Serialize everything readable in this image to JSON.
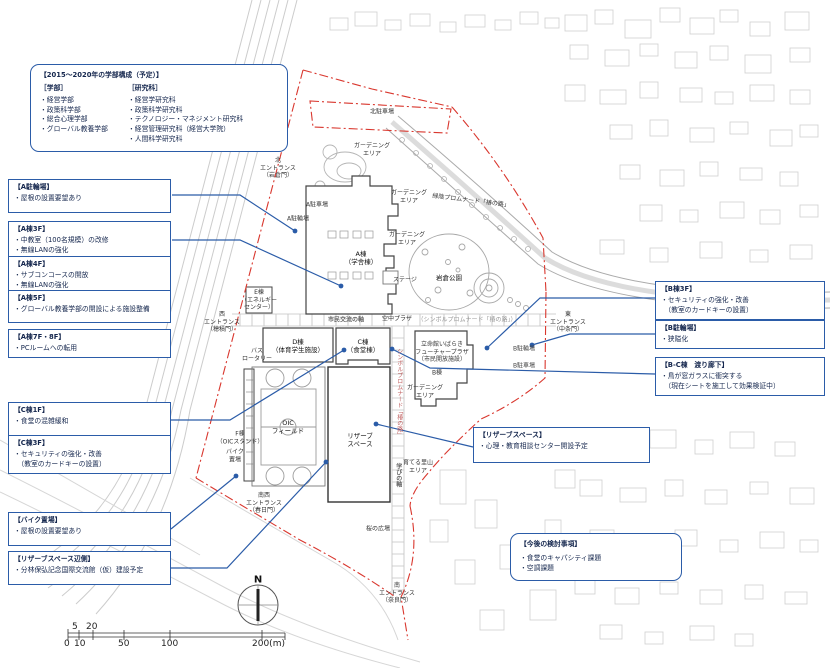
{
  "colors": {
    "accent_blue": "#2b5ca8",
    "text_navy": "#14264d",
    "boundary_red": "#d9372e",
    "building_line": "#555555",
    "context_line": "#cccccc"
  },
  "faculty_box": {
    "title": "【2015〜2020年の学部構成（予定）】",
    "departments": {
      "header": "［学部］",
      "items": [
        "・経営学部",
        "・政策科学部",
        "・総合心理学部",
        "・グローバル教養学部"
      ]
    },
    "graduate": {
      "header": "［研究科］",
      "items": [
        "・経営学研究科",
        "・政策科学研究科",
        "・テクノロジー・マネジメント研究科",
        "・経営管理研究科（経営大学院）",
        "・人間科学研究科"
      ]
    }
  },
  "callouts": {
    "a_bicycle": {
      "title": "【A駐輪場】",
      "lines": [
        "・屋根の設置要望あり"
      ]
    },
    "a3f": {
      "title": "【A棟3F】",
      "lines": [
        "・中教室（100名規模）の改修",
        "・無線LANの強化"
      ]
    },
    "a4f": {
      "title": "【A棟4F】",
      "lines": [
        "・サブコンコースの開放",
        "・無線LANの強化"
      ]
    },
    "a5f": {
      "title": "【A棟5F】",
      "lines": [
        "・グローバル教養学部の開設による施設整備"
      ]
    },
    "a7f8f": {
      "title": "【A棟7F・8F】",
      "lines": [
        "・PCルームへの転用"
      ]
    },
    "c1f": {
      "title": "【C棟1F】",
      "lines": [
        "・食堂の混雑緩和"
      ]
    },
    "c3f": {
      "title": "【C棟3F】",
      "lines": [
        "・セキュリティの強化・改善",
        "　（教室のカードキーの設置）"
      ]
    },
    "bike": {
      "title": "【バイク置場】",
      "lines": [
        "・屋根の設置要望あり"
      ]
    },
    "reserve_area": {
      "title": "【リザーブスペース辺側】",
      "lines": [
        "・分林保弘記念国際交流館（仮）建設予定"
      ]
    },
    "b3f": {
      "title": "【B棟3F】",
      "lines": [
        "・セキュリティの強化・改善",
        "　（教室のカードキーの設置）"
      ]
    },
    "b_bicycle": {
      "title": "【B駐輪場】",
      "lines": [
        "・狭隘化"
      ]
    },
    "bc_corridor": {
      "title": "【B-C棟　渡り廊下】",
      "lines": [
        "・鳥が窓ガラスに衝突する",
        "　（現在シートを施工して効果検証中）"
      ]
    },
    "reserve": {
      "title": "【リザーブスペース】",
      "lines": [
        "・心理・教育相談センター開設予定"
      ]
    },
    "future": {
      "title": "【今後の検討事項】",
      "lines": [
        "・食堂のキャパシティ課題",
        "・空調課題"
      ]
    }
  },
  "map_labels": {
    "north_parking": "北駐車場",
    "gardening_north": "ガーデニング\nエリア",
    "north_entrance": "北\nエントランス\n（岩倉門）",
    "gardening_upper": "ガーデニング\nエリア",
    "promenade_green": "緑陰プロムナード「椿の路」",
    "a_parking": "A駐車場",
    "a_bicycle": "A駐輪場",
    "gardening_mid": "ガーデニング\nエリア",
    "a_bldg": "A棟\n（学舎棟）",
    "e_bldg": "E棟\n（エネルギー\nセンター）",
    "stage": "ステージ",
    "iwakura_park": "岩倉公園",
    "west_entrance": "西\nエントランス\n（穂積門）",
    "civic_axis": "市民交流の軸",
    "sky_plaza": "空中プラザ",
    "symbol_promenade_h": "（シンボルプロムナード「椿の路」）",
    "east_entrance": "東\nエントランス\n（中条門）",
    "bus_rotary": "バス\nロータリー",
    "d_bldg": "D棟\n（体育学生施設）",
    "c_bldg": "C棟\n（食堂棟）",
    "future_plaza": "立命館いばらき\nフューチャープラザ\n（市民開放施設）",
    "b_bldg": "B棟",
    "b_bicycle": "B駐輪場",
    "b_parking": "B駐車場",
    "gardening_south": "ガーデニング\nエリア",
    "oic_field": "OIC\nフィールド",
    "f_bldg": "F棟\n（OICスタンド）",
    "reserve_space": "リザーブ\nスペース",
    "bike_area": "バイク\n置場",
    "symbol_promenade_v": "シンボルプロムナード「椿の路」",
    "learning_axis": "学びの軸",
    "satoyama": "育てる里山\nエリア",
    "sw_entrance": "南西\nエントランス\n（春日門）",
    "sakura_plaza": "桜の広場",
    "south_entrance": "南\nエントランス\n（奈良門）"
  },
  "compass": {
    "label": "N"
  },
  "scale_bar": {
    "upper": [
      "5",
      "20"
    ],
    "lower": [
      "0",
      "10",
      "50",
      "100",
      "200(m)"
    ]
  }
}
